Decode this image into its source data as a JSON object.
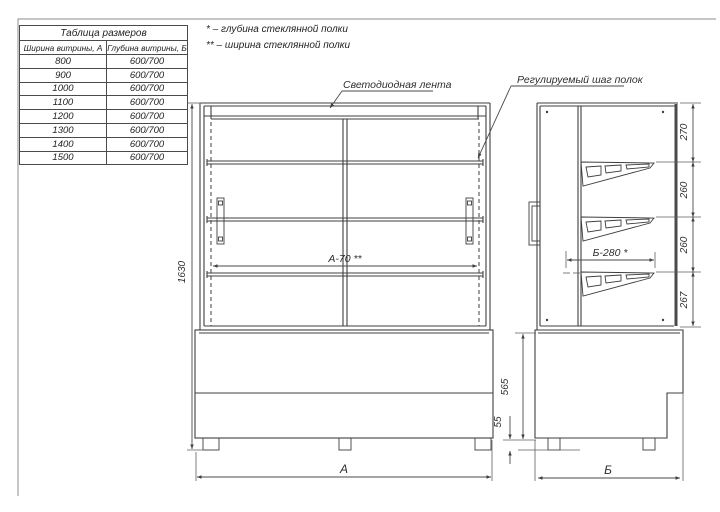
{
  "size_table": {
    "title": "Таблица размеров",
    "col_width": "Ширина витрины, А",
    "col_depth": "Глубина витрины, Б",
    "rows": [
      {
        "a": "800",
        "b": "600/700"
      },
      {
        "a": "900",
        "b": "600/700"
      },
      {
        "a": "1000",
        "b": "600/700"
      },
      {
        "a": "1100",
        "b": "600/700"
      },
      {
        "a": "1200",
        "b": "600/700"
      },
      {
        "a": "1300",
        "b": "600/700"
      },
      {
        "a": "1400",
        "b": "600/700"
      },
      {
        "a": "1500",
        "b": "600/700"
      }
    ]
  },
  "notes": {
    "depth_note": "* – глубина стеклянной полки",
    "width_note": "** – ширина стеклянной полки"
  },
  "callouts": {
    "led_strip": "Светодиодная лента",
    "shelf_pitch": "Регулируемый шаг полок"
  },
  "dims": {
    "total_height": "1630",
    "width_label": "А",
    "depth_label": "Б",
    "base_height": "565",
    "leg_height": "55",
    "spacing_top": "270",
    "spacing_2": "260",
    "spacing_3": "260",
    "spacing_4": "267",
    "inner_width": "А-70 **",
    "shelf_depth": "Б-280 *"
  },
  "colors": {
    "line": "#3f3f3f",
    "dim": "#5a5a5a"
  }
}
